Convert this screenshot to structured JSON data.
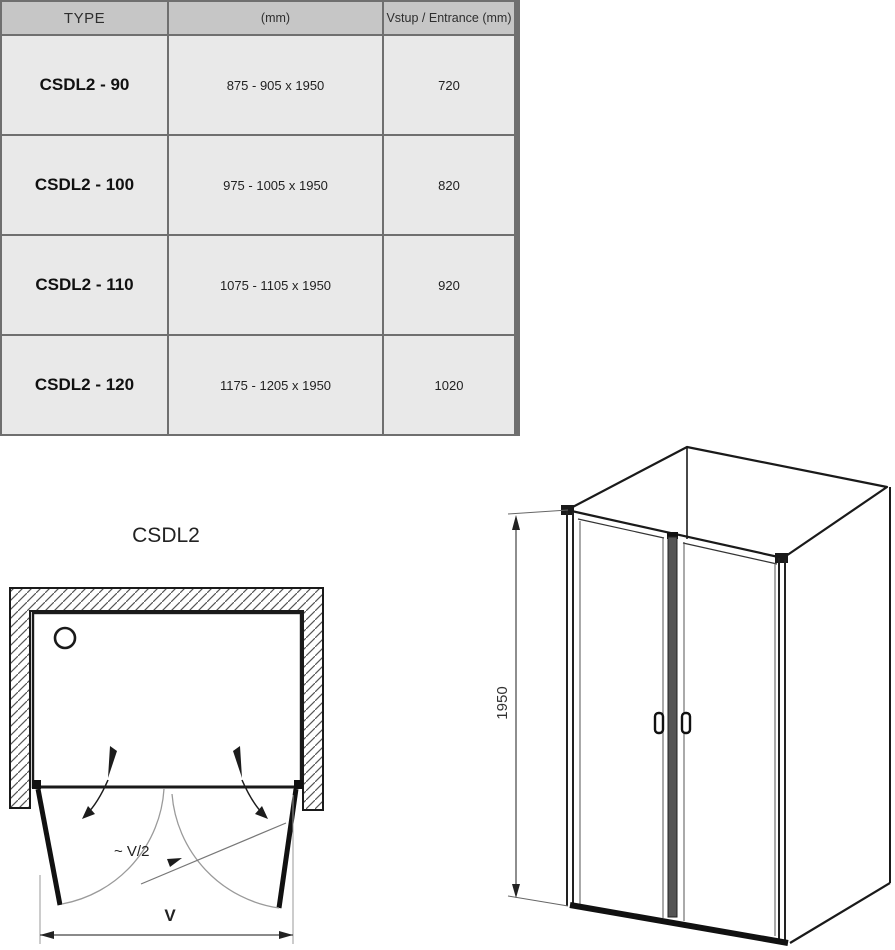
{
  "table": {
    "headers": [
      "TYPE",
      "(mm)",
      "Vstup / Entrance (mm)"
    ],
    "rows": [
      {
        "type": "CSDL2 - 90",
        "size": "875 - 905 x 1950",
        "entrance": "720"
      },
      {
        "type": "CSDL2 - 100",
        "size": "975 - 1005 x 1950",
        "entrance": "820"
      },
      {
        "type": "CSDL2 - 110",
        "size": "1075 - 1105 x 1950",
        "entrance": "920"
      },
      {
        "type": "CSDL2 - 120",
        "size": "1175 - 1205 x 1950",
        "entrance": "1020"
      }
    ],
    "colors": {
      "header_bg": "#c6c6c6",
      "row_bg": "#e9e9e9",
      "border": "#6f6f6f",
      "line_art": "#1a1a1a"
    }
  },
  "diagram": {
    "title": "CSDL2",
    "top_view": {
      "width_label": "V",
      "half_width_label": "~ V/2"
    },
    "front_view": {
      "height_label": "1950"
    }
  }
}
